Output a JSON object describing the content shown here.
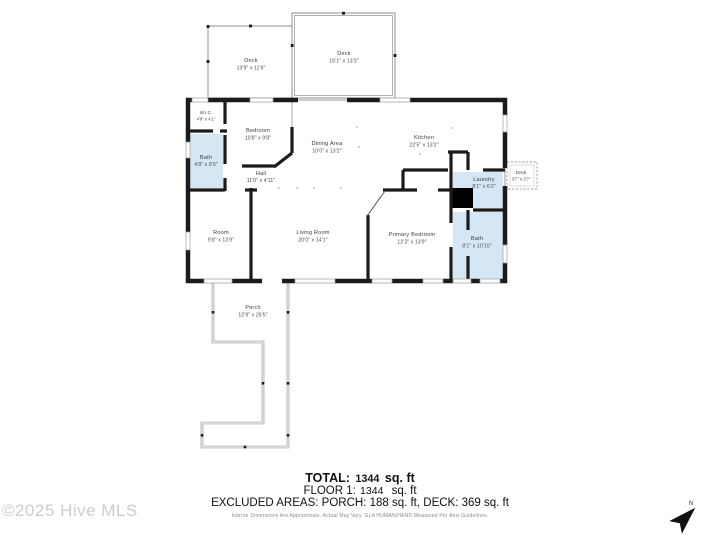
{
  "floorplan": {
    "rooms": [
      {
        "id": "deck-left",
        "name": "Deck",
        "dims": "13'9\" x 11'6\""
      },
      {
        "id": "deck-right",
        "name": "Deck",
        "dims": "15'1\" x 13'3\""
      },
      {
        "id": "wic",
        "name": "W.I.C.",
        "dims": "4'8\" x 4'1\""
      },
      {
        "id": "bath-left",
        "name": "Bath",
        "dims": "4'8\" x 8'9\""
      },
      {
        "id": "bedroom",
        "name": "Bedroom",
        "dims": "10'8\" x 9'8\""
      },
      {
        "id": "dining-area",
        "name": "Dining Area",
        "dims": "10'0\" x 13'2\""
      },
      {
        "id": "kitchen",
        "name": "Kitchen",
        "dims": "22'5\" x 13'2\""
      },
      {
        "id": "hall",
        "name": "Hall",
        "dims": "11'0\" x 4'11\""
      },
      {
        "id": "laundry",
        "name": "Laundry",
        "dims": "8'1\" x 6'2\""
      },
      {
        "id": "deck-small",
        "name": "Deck",
        "dims": "3'7\" x 3'7\""
      },
      {
        "id": "room",
        "name": "Room",
        "dims": "9'8\" x 13'9\""
      },
      {
        "id": "living-room",
        "name": "Living Room",
        "dims": "20'0\" x 14'1\""
      },
      {
        "id": "primary-bedroom",
        "name": "Primary Bedroom",
        "dims": "12'3\" x 13'9\""
      },
      {
        "id": "bath-right",
        "name": "Bath",
        "dims": "8'1\" x 10'10\""
      },
      {
        "id": "porch",
        "name": "Porch",
        "dims": "12'9\" x 25'5\""
      }
    ]
  },
  "summary": {
    "total_label": "TOTAL:",
    "total_value": "1344",
    "total_unit": "sq. ft",
    "floor_label": "FLOOR 1:",
    "floor_value": "1344",
    "floor_unit": "sq. ft",
    "excluded": "EXCLUDED AREAS: PORCH: 188 sq. ft, DECK: 369 sq. ft",
    "disclaimer": "Interior Dimensions Are Approximate. Actual May Vary. GLA HUMAN/HAND Measured Per Ansi Guidelines."
  },
  "watermark": "©2025 Hive MLS",
  "compass": {
    "north_label": "N"
  },
  "colors": {
    "wall": "#1b1b1b",
    "wet_area_fill": "#d5e7f4",
    "deck_line": "#8f8f8f",
    "watermark_gray": "#cdcdcd"
  }
}
